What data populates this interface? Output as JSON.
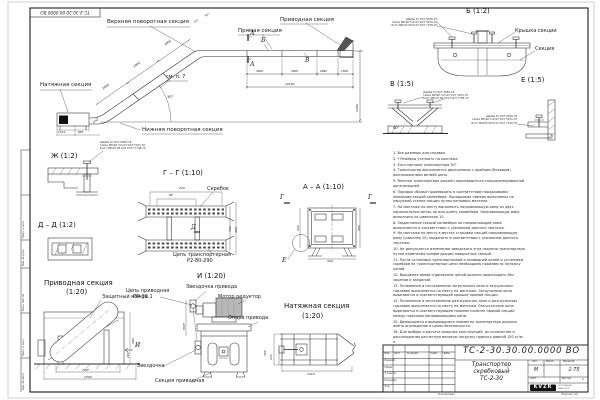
{
  "sheet": {
    "stamp_number": "ТС-2-30.30.00.0000 ВО",
    "copied": "Копировал",
    "format": "Формат А2"
  },
  "main_view": {
    "labels": {
      "upper_turn": "Верхняя поворотная секция",
      "straight": "Прямая секция",
      "drive": "Приводная секция",
      "tension": "Натяжная секция",
      "lower_turn": "Нижняя поворотная секция",
      "see_note": "см. п. 7"
    },
    "marks": {
      "a": "А",
      "b": "Б",
      "v": "В",
      "angle": "30°"
    },
    "dims": {
      "seg": "3000",
      "seg2": "2660",
      "seg3": "1500",
      "total": "10160",
      "height": "5480",
      "t1": "1515",
      "t2": "850",
      "t3": "1242",
      "u1": "612",
      "u2": "987"
    }
  },
  "details": {
    "b": {
      "title": "Б (1:2)",
      "cover": "Крышка секции",
      "section": "Секция"
    },
    "v": {
      "title": "В (1:5)",
      "angle": "60°"
    },
    "e": {
      "title": "Е (1:5)"
    },
    "zh": {
      "title": "Ж (1:2)"
    },
    "dd": {
      "title": "Д – Д (1:2)"
    },
    "gg": {
      "title": "Г – Г (1:10)",
      "scraper": "Скребок",
      "chain_line1": "Цепь транспортерная",
      "chain_line2": "Р2-80-290",
      "mark": "Д",
      "dims": {
        "w": "320",
        "w2": "80",
        "h": "700",
        "h2": "460"
      }
    },
    "aa": {
      "title": "А – А (1:10)",
      "mark_g": "Г",
      "mark_e": "Е",
      "dims": {
        "a": "100",
        "b": "380",
        "c": "340"
      }
    },
    "drive": {
      "title": "Приводная секция",
      "scale": "(1:20)",
      "casing": "Защитный кожух",
      "mark": "И",
      "dims": {
        "w": "780*",
        "w2": "1500",
        "h": "560",
        "h2": "260"
      }
    },
    "i": {
      "title": "И (1:20)",
      "chain_line1": "Цепь приводная",
      "chain_line2": "ПР-38,1",
      "drive_sprocket": "Звездочка привода",
      "motor": "Мотор редуктор",
      "support": "Опора привода",
      "sprocket": "Звездочка",
      "section": "Секция приводная",
      "dims": {
        "h": "800*"
      }
    },
    "tension": {
      "title": "Натяжная секция",
      "scale": "(1:20)",
      "dims": {
        "h": "560",
        "h2": "255",
        "w": "1515"
      }
    }
  },
  "callouts": {
    "fastener": [
      "Шайба 8 ГОСТ 6958-78",
      "Гайка М8-6Н.5.019 ГОСТ 5915-70",
      "Болт М8х25.58.019 ГОСТ 7798-70"
    ]
  },
  "notes": {
    "items": [
      "1. Все размеры для справок.",
      "2. * Размеры уточнить на монтаже.",
      "3. Угол наклона транспортера 30°.",
      "4. Транспортер выполняется двухцепным с крайним (боковым) расположением ветвей цепи.",
      "5. Монтаж транспортера должен производиться специализированной организацией.",
      "6. Порядок сборки производить в соответствии порядковыми номерами секций конвейера. Порядковые номера выполнены на наружной стенке секции путем наплавки металла.",
      "7. На монтаже по месту выполнить направляющую раму из двух параллельных веток на всю длину конвейера. Направляющую раму выполнить из швеллера 10.",
      "8. Закрепление секций конвейера на направляющей раме выполняется в соответствии с указанием данного чертежа.",
      "9. На монтаже по месту в местах стыковки секций направляющую раму (швеллер 10) подрезать в соответствии с указанием данного чертежа.",
      "10. Не допускается изменение заводского угла наклона транспортера путем изменения конфигурации поворотных секций.",
      "11. После установки транспортерной и приводной цепей и установки скребков на транспортерные цепи необходимо произвести натяжку цепей.",
      "12. Вращение валов и движение цепей должно происходить без зацепов и заеданий.",
      "13. Положение и изготовление загрузочных окон и загрузочных горловин выполняется по месту на монтаже. Загрузочные окна вырезаются в соответствующей крышке прямой секции.",
      "14. Положение и изготовление разгрузочных окон и разгрузочных горловин выполняется по месту на монтаже. Разгрузочные окна вырезаются в соответствующем нижнем полотне прямой секции между нижними направляющими цепи.",
      "15. Движущиеся и вращающиеся элементы транспортера должны иметь ограждения в целях безопасности.",
      "16. Для выбора и расчета опорных конструкций, их количества и расположения расчетную весовую нагрузку принять равной 150 кг/м. п."
    ]
  },
  "title_block": {
    "doc_number": "ТС-2-30.30.00.0000  ВО",
    "name_line1": "Транспортер",
    "name_line2": "скребковый",
    "name_line3": "ТС-2-30",
    "header_cols": [
      "Изм.",
      "Лист",
      "№ докум.",
      "Подп.",
      "Дата"
    ],
    "row_labels": [
      "Разраб.",
      "Пров.",
      "Т.контр.",
      "Н.контр.",
      "Утв."
    ],
    "lit_header": [
      "Лит.",
      "Масса",
      "Масштаб"
    ],
    "lit_value": "М",
    "scale": "1:75",
    "sheet_label": "Лист",
    "sheets_label": "Листов",
    "sheets_value": "1",
    "logo": "KVZR",
    "logo_side1": "КОТЕЛЬНЫЙ",
    "logo_side2": "ЗАВОД РФ"
  },
  "side_strip": {
    "cells": [
      "Подп. и дата",
      "Инв. № дубл.",
      "Взам. инв. №",
      "Подп. и дата",
      "Инв. № подл."
    ]
  }
}
